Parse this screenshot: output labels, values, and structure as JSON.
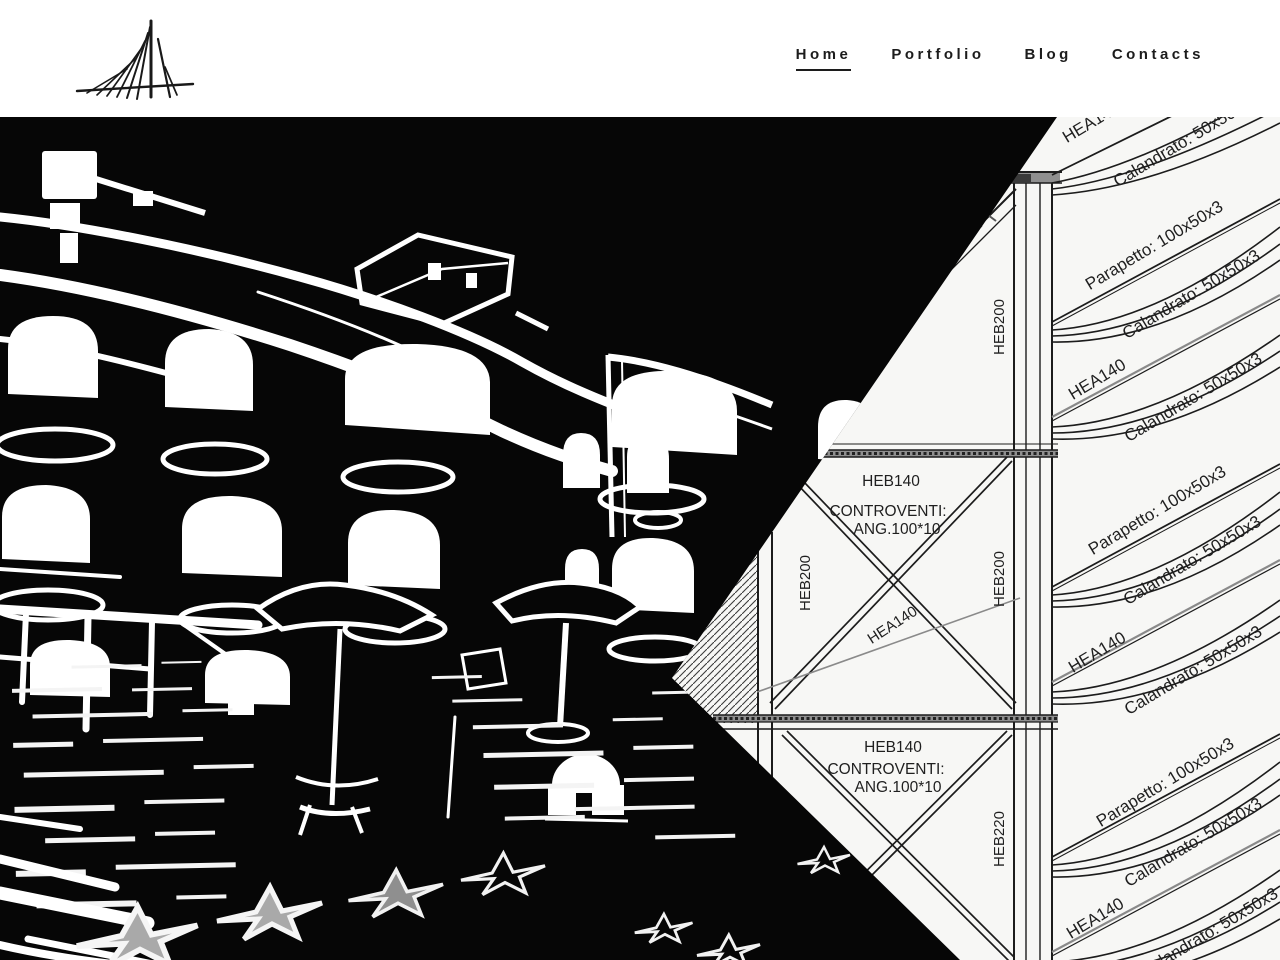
{
  "header": {
    "logo": {
      "icon": "bridge-pylon-logo"
    },
    "nav": [
      {
        "label": "Home",
        "active": true
      },
      {
        "label": "Portfolio",
        "active": false
      },
      {
        "label": "Blog",
        "active": false
      },
      {
        "label": "Contacts",
        "active": false
      }
    ]
  },
  "colors": {
    "nav_text": "#1c1c1c",
    "drawing_bg": "#f7f7f5",
    "photo_bg": "#060606",
    "slab_gray": "#8f8f8f",
    "star_gray": "#a9a9a9",
    "hea_line_gray": "#8a8a8a"
  },
  "hero": {
    "drawing_labels": [
      {
        "text": "HEB140",
        "x": 891,
        "y": 369,
        "rot": 0,
        "size": 15.5,
        "weight": "normal"
      },
      {
        "text": "CONTROVENTI:",
        "x": 888,
        "y": 399,
        "rot": 0,
        "size": 15.5,
        "weight": "normal"
      },
      {
        "text": "ANG.100*10",
        "x": 897,
        "y": 417,
        "rot": 0,
        "size": 15.5,
        "weight": "normal"
      },
      {
        "text": "HEB140",
        "x": 893,
        "y": 635,
        "rot": 0,
        "size": 15.5,
        "weight": "normal"
      },
      {
        "text": "CONTROVENTI:",
        "x": 886,
        "y": 657,
        "rot": 0,
        "size": 15.5,
        "weight": "normal"
      },
      {
        "text": "ANG.100*10",
        "x": 898,
        "y": 675,
        "rot": 0,
        "size": 15.5,
        "weight": "normal"
      },
      {
        "text": "HEB200",
        "x": 810,
        "y": 466,
        "rot": -90,
        "size": 15,
        "weight": "normal"
      },
      {
        "text": "HEB200",
        "x": 1004,
        "y": 462,
        "rot": -90,
        "size": 15,
        "weight": "normal"
      },
      {
        "text": "HEB200",
        "x": 1004,
        "y": 210,
        "rot": -90,
        "size": 15,
        "weight": "normal"
      },
      {
        "text": "HEB220",
        "x": 1004,
        "y": 722,
        "rot": -90,
        "size": 15,
        "weight": "normal"
      },
      {
        "text": "HEA140",
        "x": 895,
        "y": 512,
        "rot": -33,
        "size": 15,
        "weight": "normal"
      },
      {
        "text": "HEA140",
        "x": 1094,
        "y": 10,
        "rot": -31,
        "size": 17,
        "weight": "normal"
      },
      {
        "text": "Calandrato: 50x50x3",
        "x": 1185,
        "y": 30,
        "rot": -31,
        "size": 17,
        "weight": "normal"
      },
      {
        "text": "Parapetto: 100x50x3",
        "x": 1157,
        "y": 133,
        "rot": -31,
        "size": 17,
        "weight": "normal"
      },
      {
        "text": "Calandrato: 50x50x3",
        "x": 1194,
        "y": 182,
        "rot": -31,
        "size": 17,
        "weight": "normal"
      },
      {
        "text": "HEA140",
        "x": 1100,
        "y": 267,
        "rot": -31,
        "size": 17,
        "weight": "normal"
      },
      {
        "text": "Calandrato: 50x50x3",
        "x": 1196,
        "y": 285,
        "rot": -31,
        "size": 17,
        "weight": "normal"
      },
      {
        "text": "Parapetto: 100x50x3",
        "x": 1160,
        "y": 398,
        "rot": -31,
        "size": 17,
        "weight": "normal"
      },
      {
        "text": "Calandrato: 50x50x3",
        "x": 1195,
        "y": 448,
        "rot": -31,
        "size": 17,
        "weight": "normal"
      },
      {
        "text": "HEA140",
        "x": 1100,
        "y": 540,
        "rot": -31,
        "size": 17,
        "weight": "normal"
      },
      {
        "text": "Calandrato: 50x50x3",
        "x": 1196,
        "y": 558,
        "rot": -31,
        "size": 17,
        "weight": "normal"
      },
      {
        "text": "Parapetto: 100x50x3",
        "x": 1168,
        "y": 670,
        "rot": -31,
        "size": 17,
        "weight": "normal"
      },
      {
        "text": "Calandrato: 50x50x3",
        "x": 1196,
        "y": 730,
        "rot": -31,
        "size": 17,
        "weight": "normal"
      },
      {
        "text": "HEA140",
        "x": 1098,
        "y": 806,
        "rot": -31,
        "size": 17,
        "weight": "normal"
      },
      {
        "text": "Calandrato: 50x50x3",
        "x": 1212,
        "y": 820,
        "rot": -31,
        "size": 17,
        "weight": "normal"
      }
    ]
  }
}
